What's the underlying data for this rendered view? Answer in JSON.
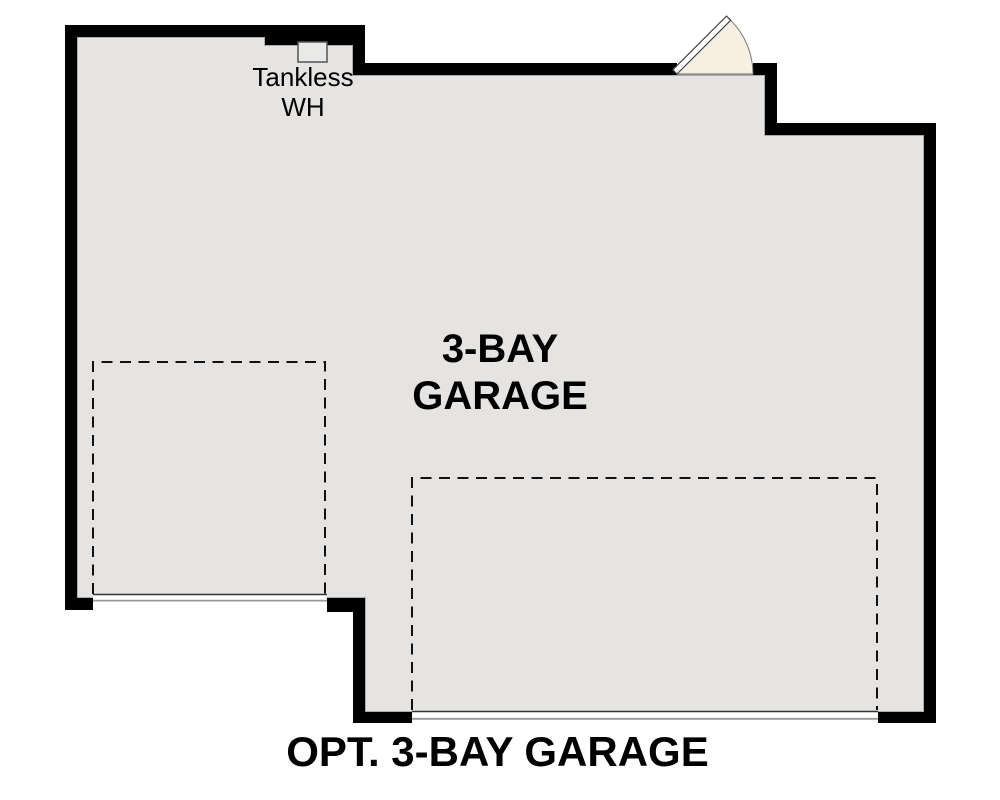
{
  "plan_title": "OPT. 3-BAY GARAGE",
  "room_label": {
    "line1": "3-BAY",
    "line2": "GARAGE"
  },
  "water_heater_label": {
    "line1": "Tankless",
    "line2": "WH"
  },
  "colors": {
    "background": "#ffffff",
    "floor": "#e5e4e2",
    "wall": "#000000",
    "interior_outline": "#9a9a9a",
    "door_fan": "#f6efe2",
    "door_leaf": "#ffffff",
    "garage_door_top_line": "#333333",
    "garage_door_bottom_line": "#999999",
    "dashed_bay_line": "#111111",
    "text": "#000000"
  }
}
